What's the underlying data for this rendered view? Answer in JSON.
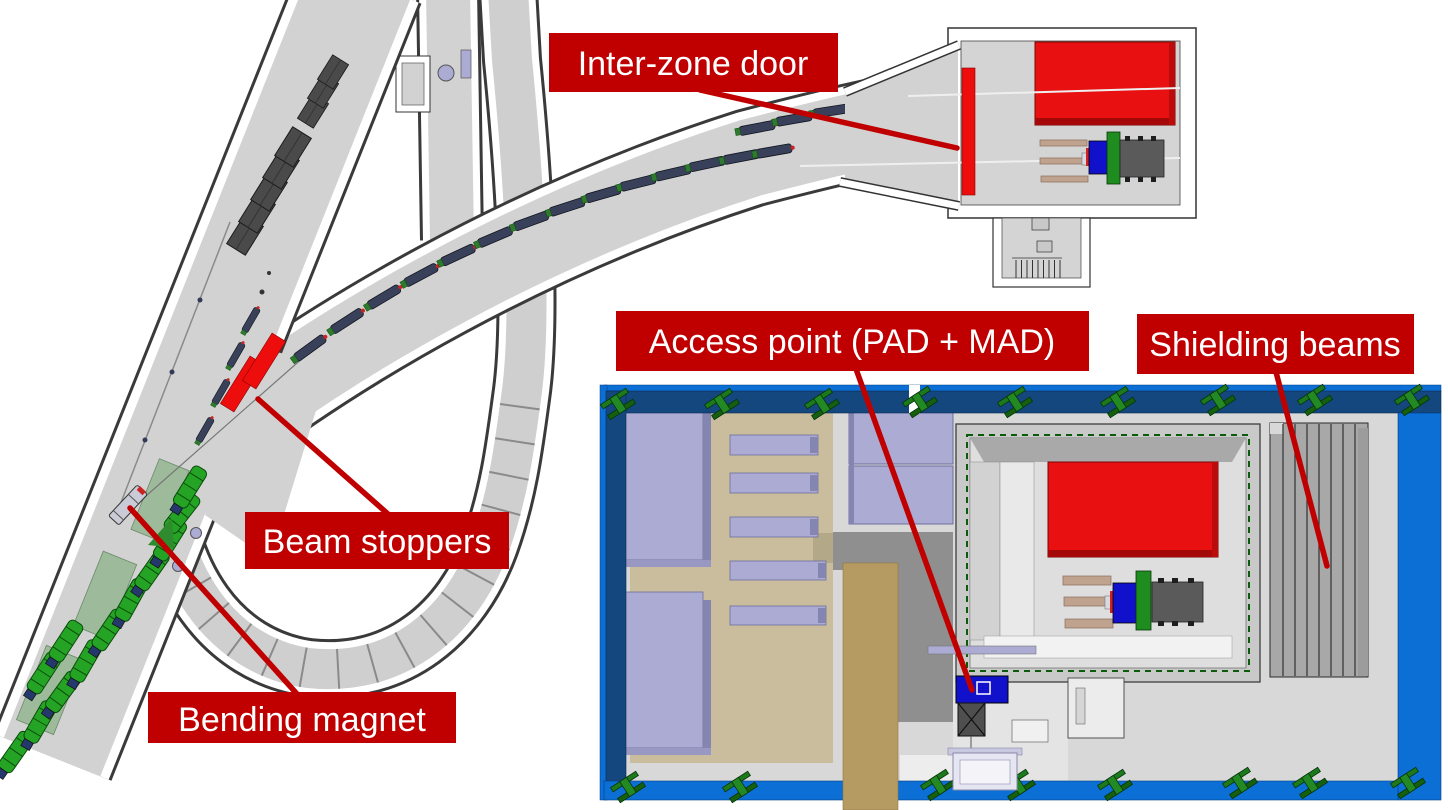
{
  "labels": {
    "inter_zone_door": {
      "text": "Inter-zone door"
    },
    "access_point": {
      "text": "Access point (PAD + MAD)"
    },
    "shielding_beams": {
      "text": "Shielding beams"
    },
    "beam_stoppers": {
      "text": "Beam stoppers"
    },
    "bending_magnet": {
      "text": "Bending magnet"
    }
  },
  "colors": {
    "label_bg": "#C00000",
    "label_text": "#FFFFFF",
    "leader_line": "#C00000",
    "highlight_red": "#EE0D0D",
    "big_block_red": "#E81010",
    "wall_blue_bright": "#0B6FD6",
    "wall_blue_dark": "#14477E",
    "ibeam_green": "#1C7A1C",
    "equipment_green": "#25A325",
    "enclosure_green_dash": "#0A5C0A",
    "lavender_block": "#ABABD3",
    "tan_floor": "#C9BD9E",
    "khaki_strip": "#B59A62",
    "tunnel_gray": "#D2D2D2",
    "floor_gray": "#D8D8D8",
    "mid_gray": "#8F8F8F",
    "shield_block_gray": "#4A4A4A",
    "access_blue": "#1111CC"
  }
}
